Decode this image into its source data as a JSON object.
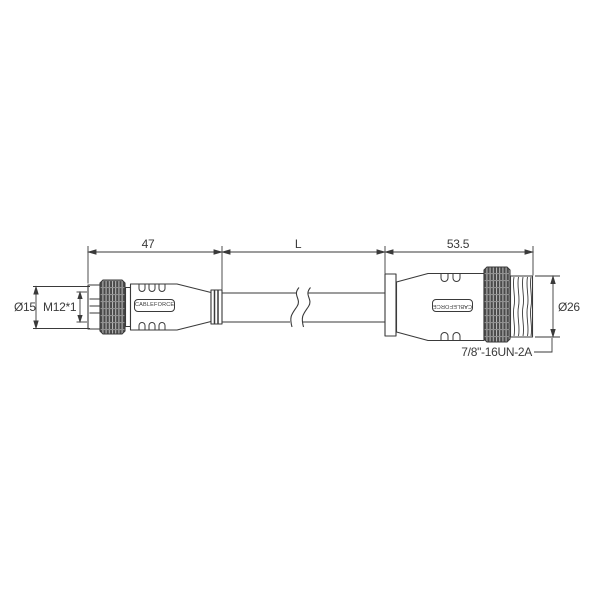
{
  "canvas": {
    "background": "#ffffff",
    "line_color": "#3a3a3a"
  },
  "dimensions": {
    "left_connector_length": "47",
    "cable_length": "L",
    "right_connector_length": "53.5",
    "left_connector_diameter": "Ø15",
    "left_thread": "M12*1",
    "right_connector_diameter": "Ø26",
    "right_thread": "7/8\"-16UN-2A"
  },
  "branding": {
    "left_plate": "CABLEFORCE",
    "right_plate": "CABLEFORCE"
  }
}
